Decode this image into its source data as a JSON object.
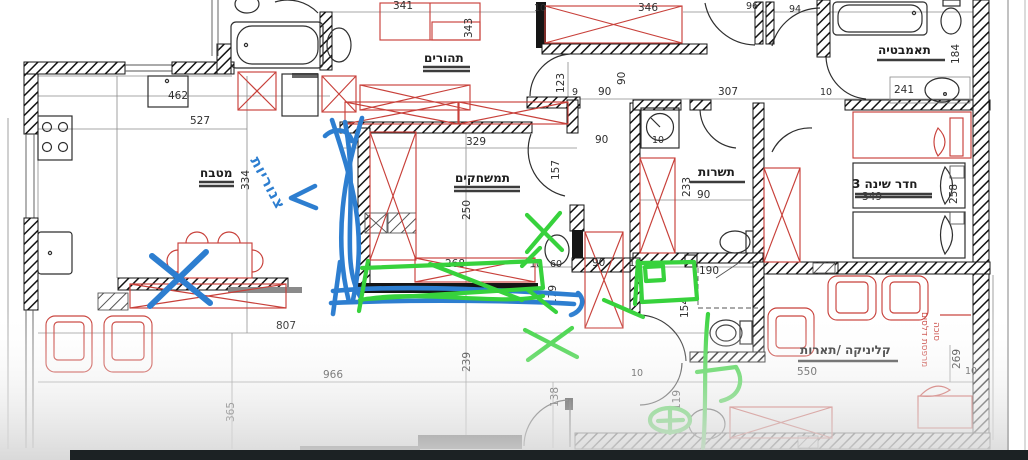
{
  "colors": {
    "wall": "#151515",
    "red": "#c8403a",
    "blue": "#2d7ed0",
    "green": "#37d23c",
    "underline": "#3c3c3c",
    "dimtext": "#2f2f2f",
    "bar": "#1c2224"
  },
  "rooms": {
    "kitchen": "מטבח",
    "parents": "תהורים",
    "playroom": "תמשחקים",
    "service": "תשרות",
    "bedroom3": "חדר שינה 3",
    "bathroom": "תאמבטיה",
    "clinic": "קליניקה /תארות",
    "balcony1": "מרפסת דלסים",
    "balcony2": "סוכה"
  },
  "handwriting": {
    "blue_note": "צנוריות"
  },
  "dims": {
    "d341": "341",
    "d343": "343",
    "d346": "346",
    "d96": "96",
    "d94": "94",
    "d462": "462",
    "d527": "527",
    "d334": "334",
    "d123": "123",
    "d9": "9",
    "d90a": "90",
    "d90b": "90",
    "d90c": "90",
    "d90d": "90",
    "d90e": "90",
    "d307": "307",
    "d10a": "10",
    "d10b": "10",
    "d10c": "10",
    "d10d": "10",
    "d10e": "10",
    "d10f": "10",
    "d10g": "10",
    "d241": "241",
    "d184": "184",
    "d157": "157",
    "d329": "329",
    "d250": "250",
    "d233": "233",
    "d349": "349",
    "d258": "258",
    "d268": "268",
    "d60": "60",
    "d179": "179",
    "d190": "190",
    "d154": "154",
    "d807": "807",
    "d966": "966",
    "d365": "365",
    "d239": "239",
    "d138": "138",
    "d119": "119",
    "d550": "550",
    "d269": "269"
  }
}
